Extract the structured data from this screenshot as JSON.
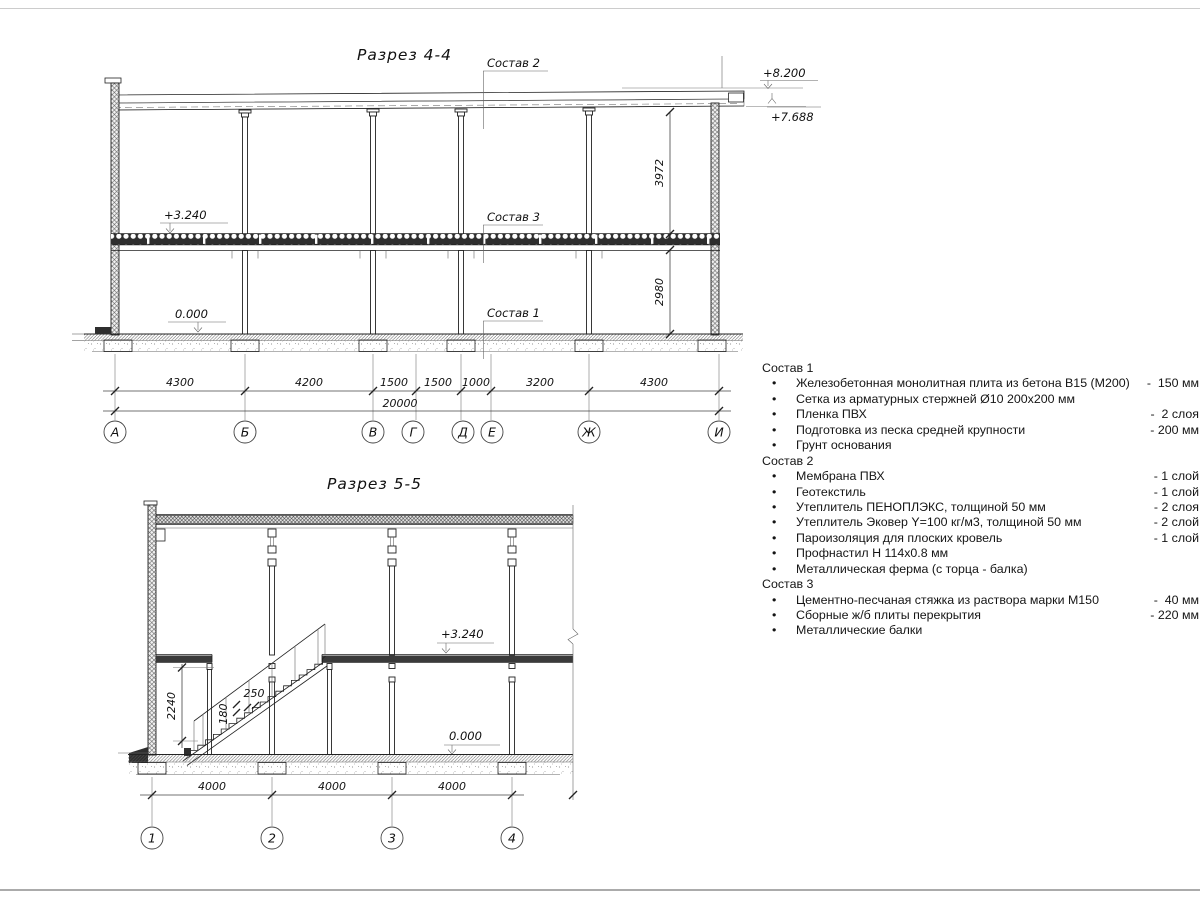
{
  "s44": {
    "title": "Разрез 4-4",
    "leaders": {
      "sostav1": "Состав 1",
      "sostav2": "Состав 2",
      "sostav3": "Состав 3"
    },
    "elev": {
      "top": "+8.200",
      "eave": "+7.688",
      "floor": "+3.240",
      "ground": "0.000"
    },
    "dims": {
      "spans": [
        "4300",
        "4200",
        "1500",
        "1500",
        "1000",
        "3200",
        "4300"
      ],
      "total": "20000",
      "upper": "3972",
      "lower": "2980"
    },
    "axes": [
      "А",
      "Б",
      "В",
      "Г",
      "Д",
      "Е",
      "Ж",
      "И"
    ]
  },
  "s55": {
    "title": "Разрез 5-5",
    "elev": {
      "floor": "+3.240",
      "ground": "0.000"
    },
    "dims": {
      "spans": [
        "4000",
        "4000",
        "4000"
      ],
      "height": "2240",
      "tread": "250",
      "riser": "180"
    },
    "axes": [
      "1",
      "2",
      "3",
      "4"
    ]
  },
  "notes": {
    "sections": [
      {
        "title": "Состав 1",
        "items": [
          {
            "name": "Железобетонная монолитная плита из бетона В15 (М200)",
            "value": "-  150 мм"
          },
          {
            "name": "Сетка из арматурных стержней Ø10 200х200 мм",
            "value": ""
          },
          {
            "name": "Пленка ПВХ",
            "value": "-  2 слоя"
          },
          {
            "name": "Подготовка из песка средней крупности",
            "value": "- 200 мм"
          },
          {
            "name": "Грунт основания",
            "value": ""
          }
        ]
      },
      {
        "title": "Состав 2",
        "items": [
          {
            "name": "Мембрана ПВХ",
            "value": "- 1 слой"
          },
          {
            "name": "Геотекстиль",
            "value": "- 1 слой"
          },
          {
            "name": "Утеплитель ПЕНОПЛЭКС, толщиной 50 мм",
            "value": "- 2 слоя"
          },
          {
            "name": "Утеплитель Эковер Y=100 кг/м3, толщиной 50 мм",
            "value": "- 2 слой"
          },
          {
            "name": "Пароизоляция для плоских кровель",
            "value": "- 1 слой"
          },
          {
            "name": "Профнастил Н 114х0.8 мм",
            "value": ""
          },
          {
            "name": "Металлическая ферма (с торца - балка)",
            "value": ""
          }
        ]
      },
      {
        "title": "Состав 3",
        "items": [
          {
            "name": "Цементно-песчаная стяжка из раствора марки М150",
            "value": "-  40 мм"
          },
          {
            "name": "Сборные ж/б плиты перекрытия",
            "value": "- 220 мм"
          },
          {
            "name": "Металлические балки",
            "value": ""
          }
        ]
      }
    ]
  }
}
